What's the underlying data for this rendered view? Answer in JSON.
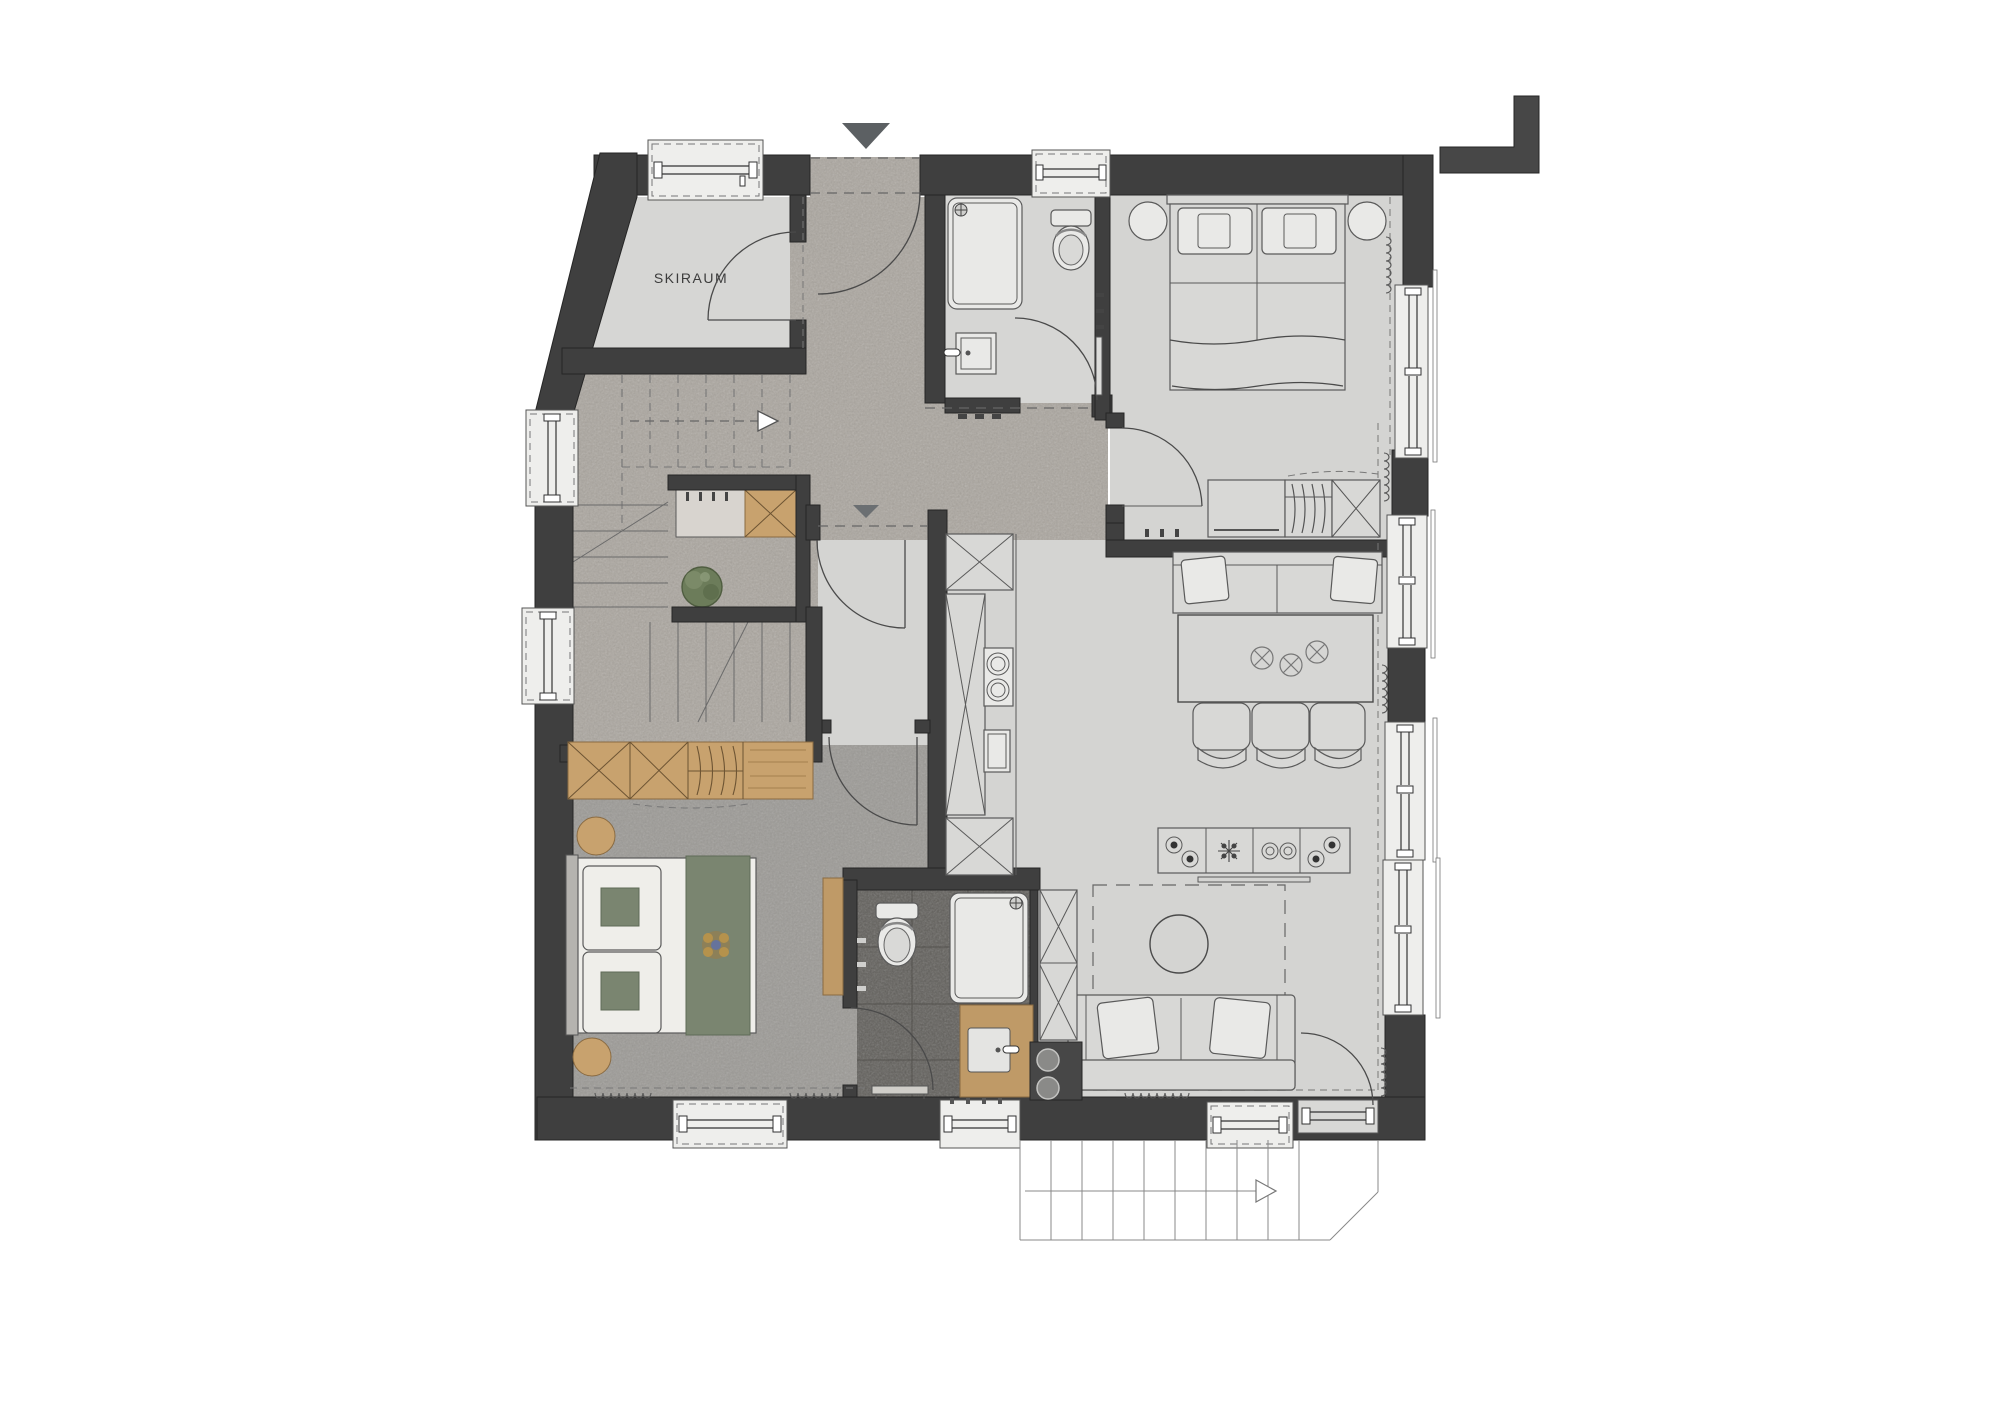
{
  "plan": {
    "room_label": "SKIRAUM",
    "markers": {
      "entrance_marker": "filled-triangle-down",
      "inner_door_marker": "filled-triangle-down",
      "stair_up_arrow": "dashed-arrow-right",
      "terrace_stairs_arrow": "arrow-right"
    },
    "colors": {
      "wall": "#3f3f3f",
      "room_floor_light": "#d4d4d2",
      "hall_floor_stone": "#a9a49e",
      "bedroom_floor_concrete": "#9c9a96",
      "bathroom_floor_dark": "#615f5b",
      "wood": "#c8a26e",
      "textile_green": "#7a8570",
      "bedding_white": "#efeeea",
      "outline": "#4a4a4a"
    }
  }
}
